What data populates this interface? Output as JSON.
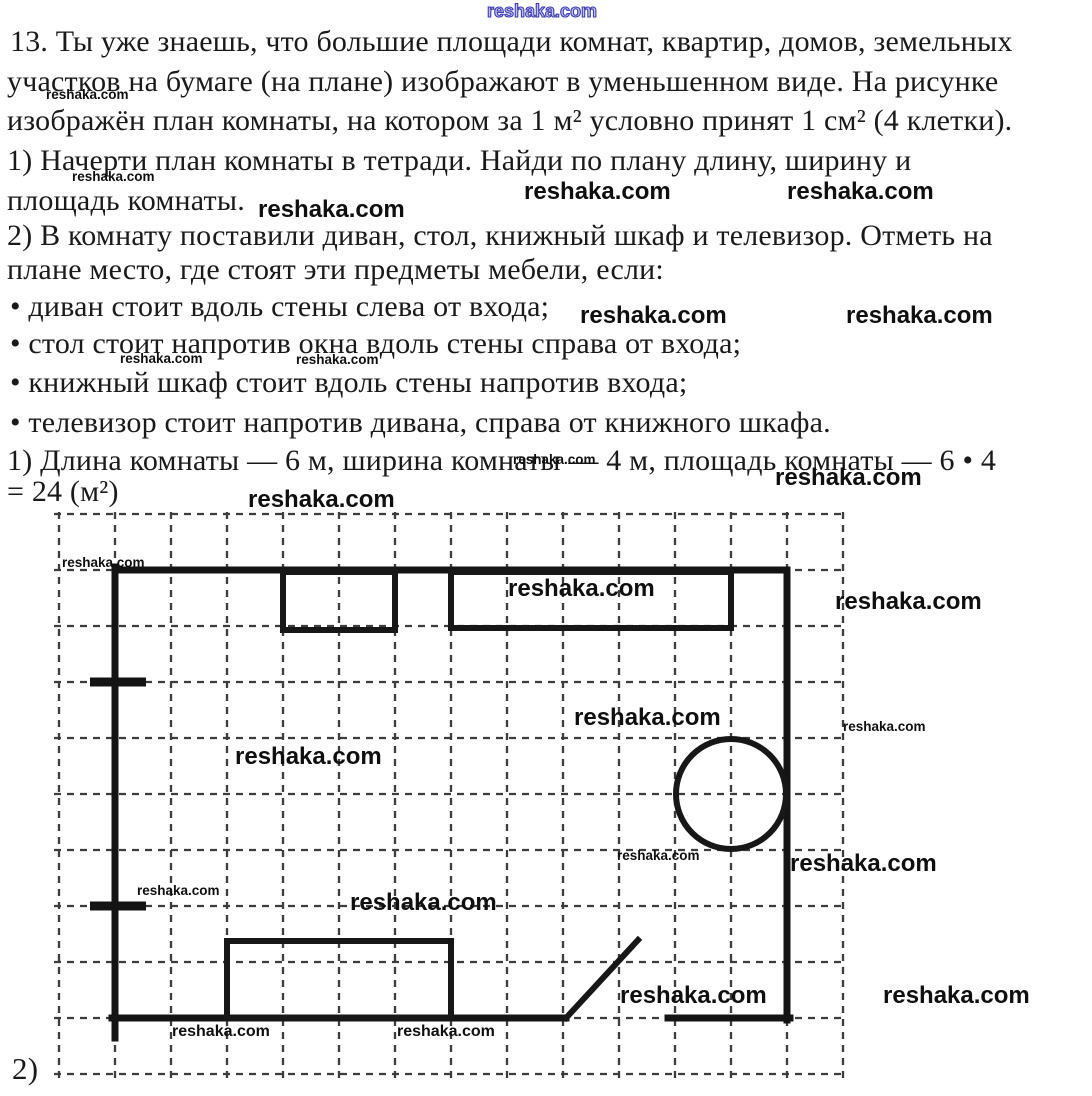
{
  "page": {
    "background": "#ffffff",
    "ink": "#1a1a1a"
  },
  "document": {
    "lines": [
      "13. Ты уже знаешь, что большие площади комнат, квартир, домов, земельных",
      "участков на бумаге (на плане) изображают в уменьшенном виде. На рисунке",
      "изображён план комнаты, на котором за 1 м² условно принят 1 см² (4 клетки).",
      "1) Начерти план комнаты в тетради. Найди по плану длину, ширину и",
      "площадь комнаты.",
      "2) В комнату поставили диван, стол, книжный шкаф и телевизор. Отметь на",
      "плане место, где стоят эти предметы мебели, если:",
      "• диван стоит вдоль стены слева от входа;",
      "• стол стоит напротив окна вдоль стены справа от входа;",
      "• книжный шкаф стоит вдоль стены напротив входа;",
      "• телевизор стоит напротив дивана, справа от книжного шкафа.",
      "1) Длина комнаты — 6 м, ширина комнаты — 4 м, площадь комнаты — 6 • 4",
      "= 24 (м²)"
    ],
    "answer": {
      "length_m": "6",
      "width_m": "4",
      "area_m2": "24"
    },
    "part2_label": "2)"
  },
  "watermarks": {
    "text": "reshaka.com",
    "blue_color": "#3a3ab5",
    "items": [
      {
        "x": 487,
        "y": 2,
        "size": "blue"
      },
      {
        "x": 46,
        "y": 88,
        "size": "s"
      },
      {
        "x": 72,
        "y": 170,
        "size": "s"
      },
      {
        "x": 524,
        "y": 180,
        "size": "l"
      },
      {
        "x": 787,
        "y": 180,
        "size": "l"
      },
      {
        "x": 258,
        "y": 198,
        "size": "l"
      },
      {
        "x": 580,
        "y": 304,
        "size": "l"
      },
      {
        "x": 846,
        "y": 304,
        "size": "l"
      },
      {
        "x": 120,
        "y": 352,
        "size": "s"
      },
      {
        "x": 296,
        "y": 353,
        "size": "s"
      },
      {
        "x": 513,
        "y": 453,
        "size": "s"
      },
      {
        "x": 775,
        "y": 466,
        "size": "l"
      },
      {
        "x": 248,
        "y": 488,
        "size": "l"
      },
      {
        "x": 62,
        "y": 556,
        "size": "s"
      },
      {
        "x": 508,
        "y": 577,
        "size": "l"
      },
      {
        "x": 835,
        "y": 590,
        "size": "l"
      },
      {
        "x": 574,
        "y": 706,
        "size": "l"
      },
      {
        "x": 843,
        "y": 720,
        "size": "s"
      },
      {
        "x": 235,
        "y": 745,
        "size": "l"
      },
      {
        "x": 617,
        "y": 849,
        "size": "s"
      },
      {
        "x": 790,
        "y": 852,
        "size": "l"
      },
      {
        "x": 137,
        "y": 884,
        "size": "s"
      },
      {
        "x": 350,
        "y": 891,
        "size": "l"
      },
      {
        "x": 620,
        "y": 984,
        "size": "l"
      },
      {
        "x": 883,
        "y": 984,
        "size": "l"
      },
      {
        "x": 172,
        "y": 1024,
        "size": "m"
      },
      {
        "x": 397,
        "y": 1024,
        "size": "m"
      }
    ]
  },
  "plan": {
    "grid": {
      "x0": 59,
      "y0": 514,
      "cell": 56,
      "cols": 14,
      "rows": 10,
      "x_min": 54,
      "x_max": 847,
      "y_min": 512,
      "y_max": 1078
    },
    "room_px": {
      "left": 115,
      "top": 570,
      "right": 787,
      "bottom": 1018
    },
    "room_cells": {
      "cols": 12,
      "rows": 8
    },
    "walls": [
      [
        115,
        570,
        787,
        570
      ],
      [
        115,
        567,
        115,
        1038
      ],
      [
        787,
        570,
        787,
        1020
      ],
      [
        112,
        1018,
        566,
        1018
      ],
      [
        668,
        1018,
        790,
        1018
      ]
    ],
    "window_marks": [
      [
        90,
        682,
        146,
        682
      ],
      [
        90,
        906,
        146,
        906
      ]
    ],
    "door_swing": [
      566,
      1018,
      638,
      940
    ],
    "furniture": {
      "tv": {
        "shape": "rect",
        "x": 283,
        "y": 572,
        "w": 112,
        "h": 58
      },
      "bookshelf": {
        "shape": "rect",
        "x": 451,
        "y": 572,
        "w": 280,
        "h": 56
      },
      "sofa": {
        "shape": "rect",
        "x": 227,
        "y": 941,
        "w": 224,
        "h": 77
      },
      "table": {
        "shape": "circle",
        "cx": 731,
        "cy": 794,
        "r": 55
      }
    }
  }
}
